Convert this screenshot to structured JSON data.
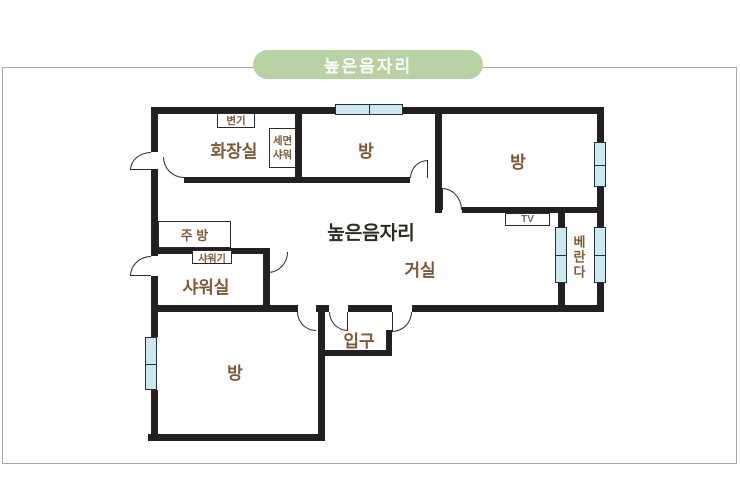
{
  "badge": {
    "label": "높은음자리"
  },
  "plan": {
    "title": "높은음자리",
    "rooms": {
      "bathroom": "화장실",
      "room_top_middle": "방",
      "room_top_right": "방",
      "living_room": "거실",
      "shower_room": "샤워실",
      "room_bottom_left": "방",
      "entrance": "입구",
      "veranda": "베란다"
    },
    "fixtures": {
      "toilet": "변기",
      "washbasin_line1": "세면",
      "washbasin_line2": "샤워",
      "kitchen": "주 방",
      "shower_head": "샤워기",
      "tv": "TV"
    }
  },
  "colors": {
    "badge_bg": "#b7d3a4",
    "badge_text": "#ffffff",
    "wall": "#241f20",
    "label_brown": "#7d5a34",
    "title_text": "#2e2a26",
    "window_fill": "#cbe7f0",
    "frame_border": "#a8a8a8",
    "tv_text": "#6b6b6b"
  }
}
